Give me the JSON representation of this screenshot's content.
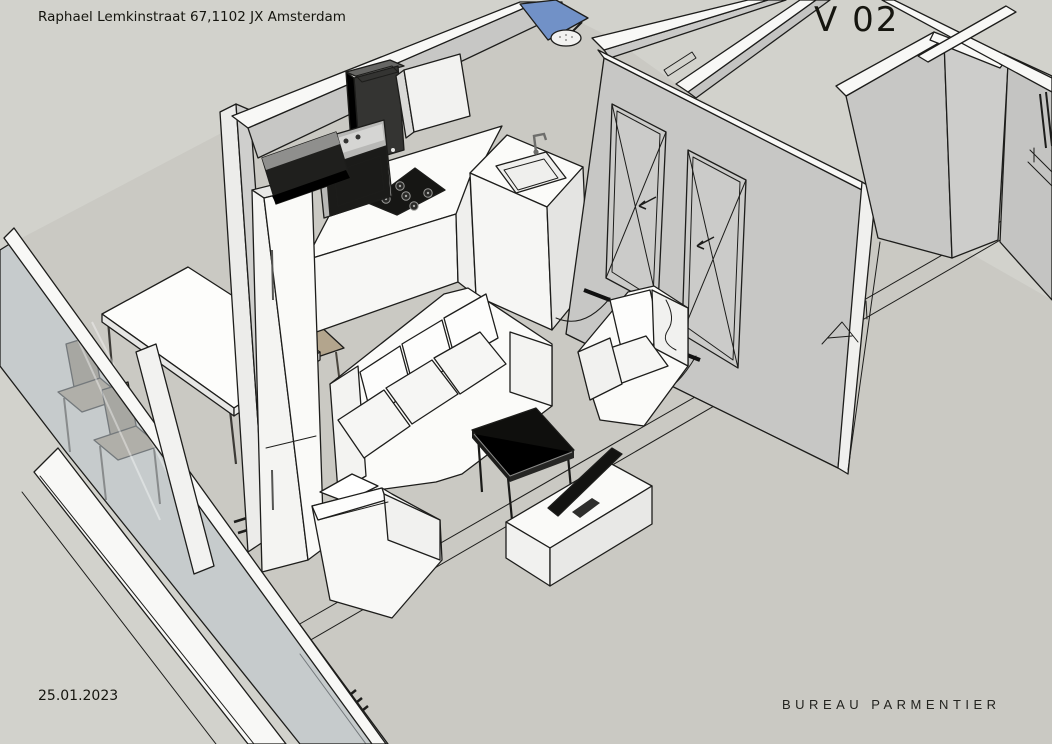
{
  "annotations": {
    "address": "Raphael Lemkinstraat 67,1102 JX Amsterdam",
    "version_label": "V 02",
    "date": "25.01.2023",
    "studio": "BUREAU PARMENTIER"
  },
  "palette": {
    "bg": "#d2d2cc",
    "floor": "#cac9c3",
    "wall": "#c7c7c5",
    "band": "#f8f8f6",
    "ink": "#1d1d1b",
    "white": "#fbfbf9",
    "glass": "#b9c3c9",
    "blueGlass": "#7191c7",
    "black": "#141412",
    "steel": "#b8b8b6",
    "tan": "#b3a58d"
  },
  "scene": {
    "type": "3d-floorplan-render",
    "objects": [
      "glass-facade",
      "dining-table",
      "dining-chairs",
      "kitchen-counter",
      "sink",
      "gas-hob",
      "oven",
      "range-hood",
      "fridge",
      "extractor-column",
      "wall-cabinet",
      "shower-glass",
      "shower-head",
      "interior-doors",
      "sofa",
      "armchairs",
      "coffee-table",
      "tv-stand",
      "tv",
      "interior-walls"
    ]
  }
}
